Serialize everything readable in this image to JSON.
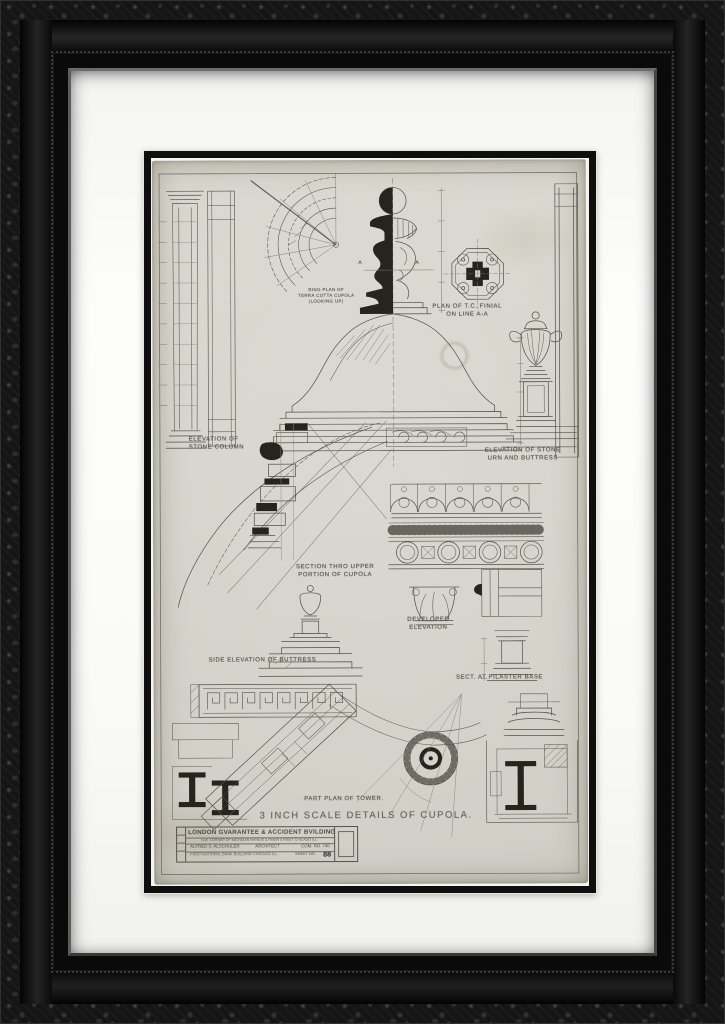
{
  "artwork": {
    "main_title": "3 INCH SCALE DETAILS OF CUPOLA.",
    "labels": {
      "elevation_stone_column": "ELEVATION OF\nSTONE COLUMN",
      "ring_plan": "RING PLAN OF\nTERRA COTTA CUPOLA\n(LOOKING UP)",
      "plan_finial": "PLAN OF T.C. FINIAL\nON LINE A-A",
      "elevation_stone_urn": "ELEVATION OF STONE\nURN AND BUTTRESS",
      "section_upper_cupola": "SECTION THRO UPPER\nPORTION OF CUPOLA",
      "developed_elevation": "DEVELOPED ELEVATION",
      "side_elevation_buttress": "SIDE ELEVATION OF BUTTRESS",
      "sect_pilaster_base": "SECT. AT PILASTER BASE",
      "part_plan_tower": "PART PLAN OF TOWER.",
      "section_marker": "A"
    },
    "title_block": {
      "name": "LONDON GVARANTEE & ACCIDENT BVILDING",
      "address": "N.W. CORNER OF MICHIGAN AVENUE & RIVER STREET CHICAGO ILL.",
      "architect": "ALFRED S. ALSCHULER",
      "architect_title": "ARCHITECT",
      "commission": "COM. NO. 740",
      "office": "FIRST NATIONAL BANK BUILDING CHICAGO ILL.",
      "sheet": "SHEET NO.",
      "sheet_number": "88"
    },
    "colors": {
      "frame": "#151515",
      "mat": "#fbfbf8",
      "fillet": "#0e0e0e",
      "paper": "#d5d3ca",
      "ink": "#55524a",
      "ink_dark": "#26241f"
    }
  }
}
